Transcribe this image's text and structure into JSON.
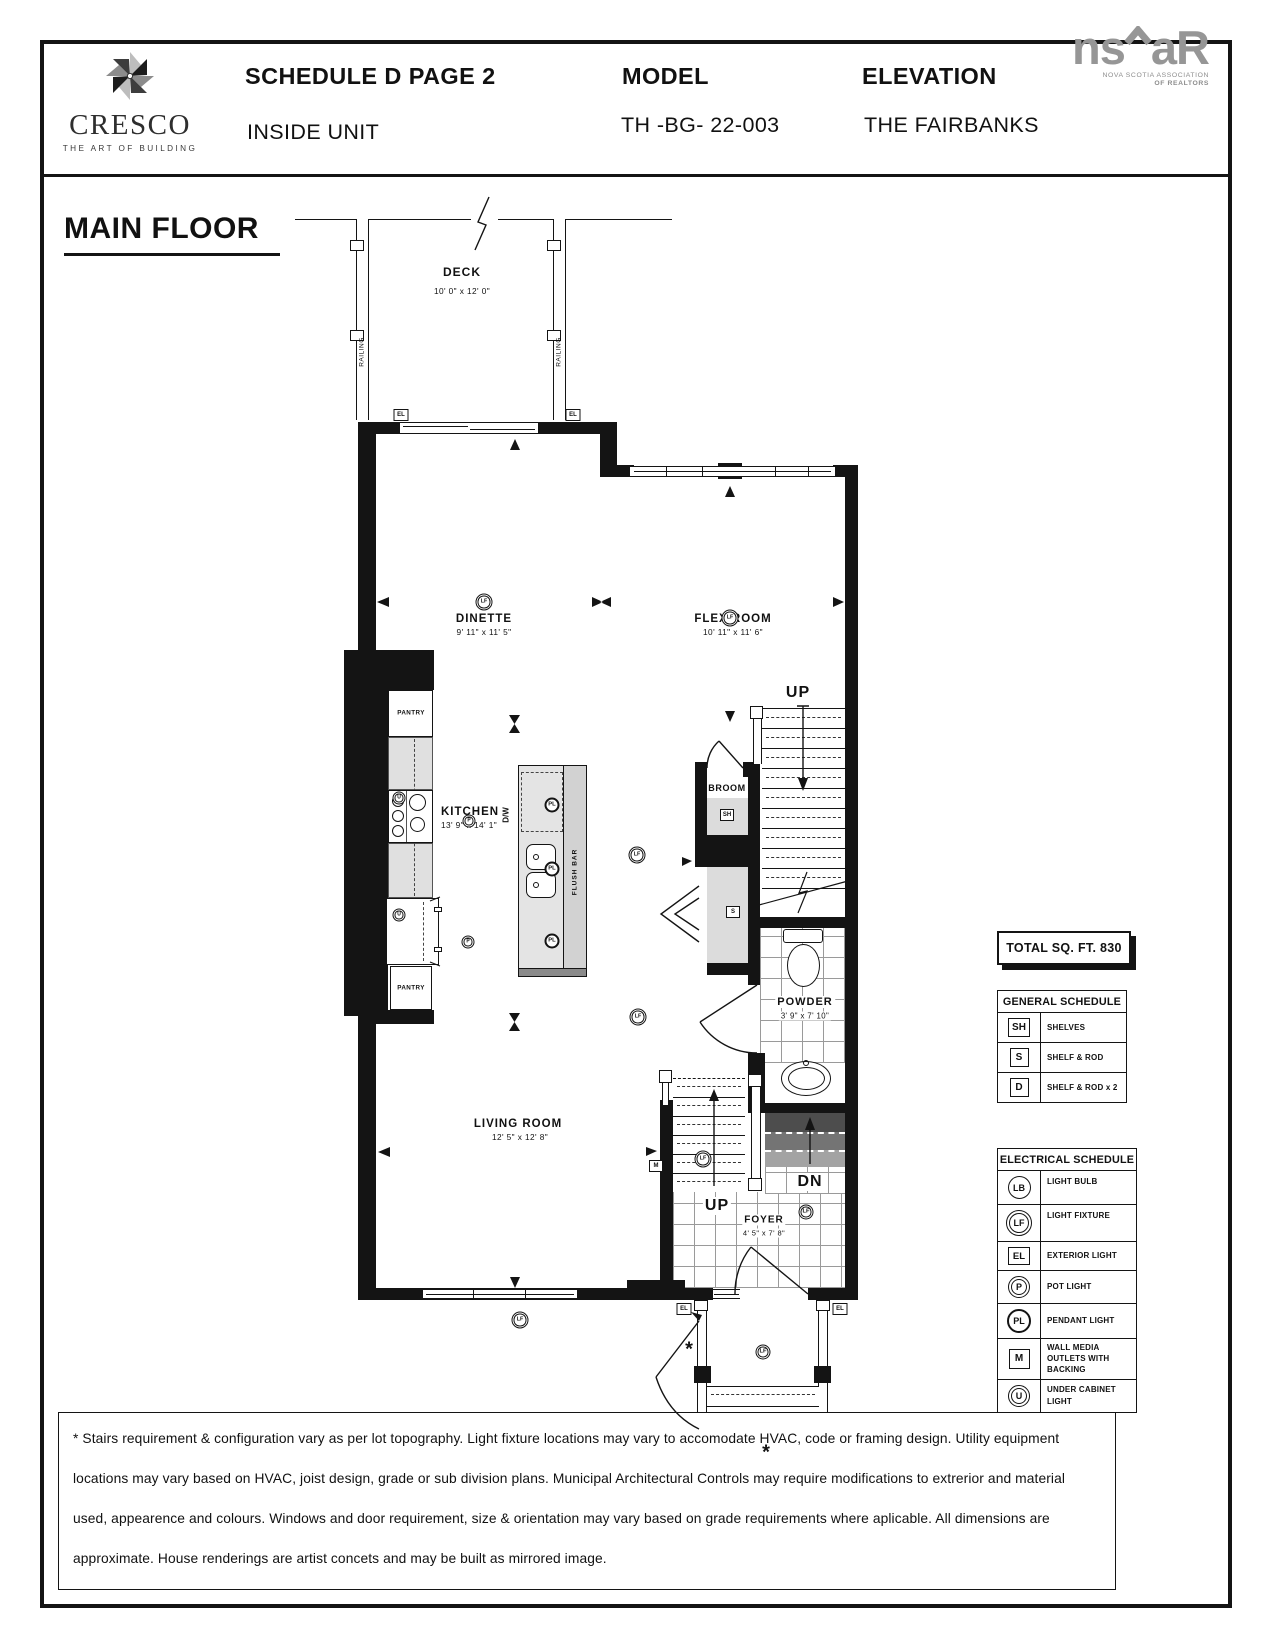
{
  "header": {
    "brand": {
      "name": "CRESCO",
      "tagline": "THE ART OF BUILDING"
    },
    "doc_title": "SCHEDULE D PAGE 2",
    "doc_subtitle": "INSIDE UNIT",
    "model_label": "MODEL",
    "model_value": "TH -BG- 22-003",
    "elevation_label": "ELEVATION",
    "elevation_value": "THE FAIRBANKS",
    "association": {
      "abbr_left": "ns",
      "abbr_right": "aR",
      "line1": "NOVA SCOTIA ASSOCIATION",
      "line2": "OF REALTORS"
    }
  },
  "floor_label": "MAIN FLOOR",
  "rooms": {
    "deck": {
      "name": "DECK",
      "dims": "10' 0\" x 12' 0\""
    },
    "dinette": {
      "name": "DINETTE",
      "dims": "9' 11\" x 11' 5\""
    },
    "flex": {
      "name": "FLEX ROOM",
      "dims": "10' 11\" x 11' 6\""
    },
    "kitchen": {
      "name": "KITCHEN",
      "dims": "13' 9\" x 14' 1\""
    },
    "broom": {
      "name": "BROOM"
    },
    "powder": {
      "name": "POWDER",
      "dims": "3' 9\" x 7' 10\""
    },
    "living": {
      "name": "LIVING ROOM",
      "dims": "12' 5\" x 12' 8\""
    },
    "foyer": {
      "name": "FOYER",
      "dims": "4' 5\" x 7' 8\""
    }
  },
  "plan_labels": {
    "railing": "RAILING",
    "pantry": "PANTRY",
    "dw": "D/W",
    "flush_bar": "FLUSH BAR",
    "up": "UP",
    "dn": "DN",
    "asterisk": "*"
  },
  "symbols": {
    "lf": "LF",
    "lb": "LB",
    "el": "EL",
    "p": "P",
    "pl": "PL",
    "m": "M",
    "u": "U",
    "sh": "SH",
    "s": "S",
    "d": "D"
  },
  "total_sqft_label": "TOTAL SQ. FT. 830",
  "general_schedule": {
    "title": "GENERAL SCHEDULE",
    "rows": [
      {
        "symbol": "SH",
        "label": "SHELVES"
      },
      {
        "symbol": "S",
        "label": "SHELF & ROD"
      },
      {
        "symbol": "D",
        "label": "SHELF & ROD x 2"
      }
    ]
  },
  "electrical_schedule": {
    "title": "ELECTRICAL SCHEDULE",
    "rows": [
      {
        "symbol": "LB",
        "label": "LIGHT BULB"
      },
      {
        "symbol": "LF",
        "label": "LIGHT FIXTURE"
      },
      {
        "symbol": "EL",
        "label": "EXTERIOR LIGHT"
      },
      {
        "symbol": "P",
        "label": "POT LIGHT"
      },
      {
        "symbol": "PL",
        "label": "PENDANT LIGHT"
      },
      {
        "symbol": "M",
        "label": "WALL MEDIA OUTLETS WITH BACKING"
      },
      {
        "symbol": "U",
        "label": "UNDER CABINET LIGHT"
      }
    ]
  },
  "disclaimer": "* Stairs requirement & configuration vary as per lot topography. Light fixture locations may vary to accomodate HVAC, code or framing design. Utility equipment locations may vary based on HVAC, joist design, grade or sub division plans. Municipal Architectural Controls may require modifications to extrerior and material used, appearence and colours. Windows and door requirement, size & orientation may vary based on grade requirements where aplicable. All dimensions are approximate. House renderings are artist concets and may be built as mirrored image."
}
